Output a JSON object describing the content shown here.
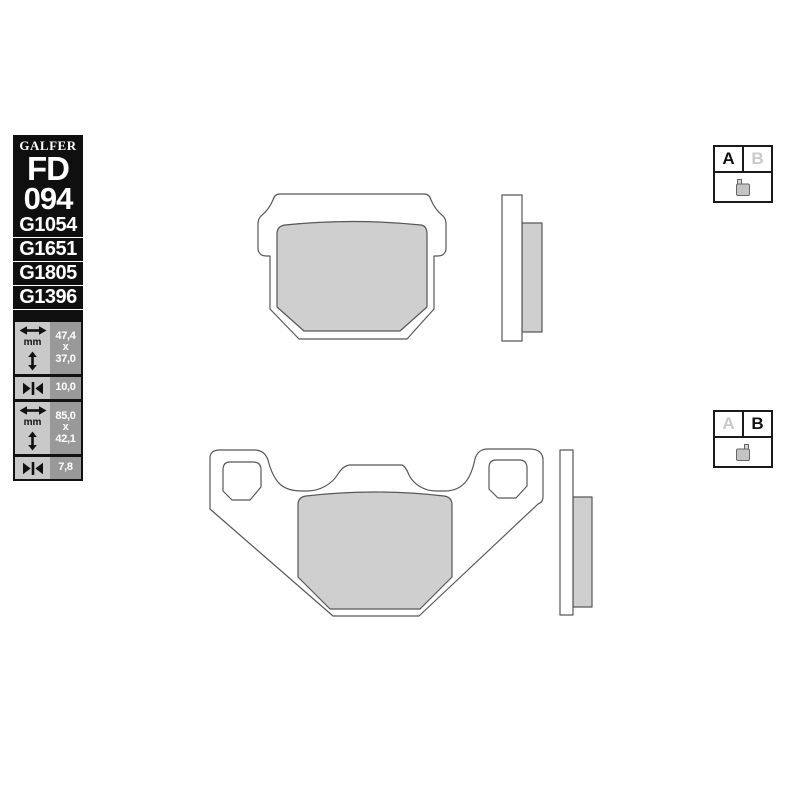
{
  "sidebar": {
    "brand": "GALFER",
    "series": "FD",
    "number": "094",
    "codes": [
      "G1054",
      "G1651",
      "G1805",
      "G1396"
    ],
    "dims": [
      {
        "unit": "mm",
        "lines": [
          "47,4",
          "x",
          "37,0"
        ]
      },
      {
        "value": "10,0"
      },
      {
        "unit": "mm",
        "lines": [
          "85,0",
          "x",
          "42,1"
        ]
      },
      {
        "value": "7,8"
      }
    ]
  },
  "selectors": [
    {
      "options": [
        "A",
        "B"
      ],
      "active": "A"
    },
    {
      "options": [
        "A",
        "B"
      ],
      "active": "B"
    }
  ],
  "icons": {
    "width_arrow": "left-right-arrow-icon",
    "height_arrow": "up-down-arrow-icon",
    "thickness_arrow": "inward-arrows-icon",
    "pad_shape": "brake-pad-icon"
  },
  "colors": {
    "sidebar_bg": "#0f0f0f",
    "sidebar_text": "#ffffff",
    "dim_icon_bg": "#c9c9c9",
    "dim_value_bg": "#999999",
    "dim_text": "#ffffff",
    "plate_fill": "#ffffff",
    "pad_fill": "#cfcfcf",
    "outline": "#575757",
    "selector_active": "#111111",
    "selector_inactive": "#c9c9c9",
    "background": "#ffffff"
  }
}
